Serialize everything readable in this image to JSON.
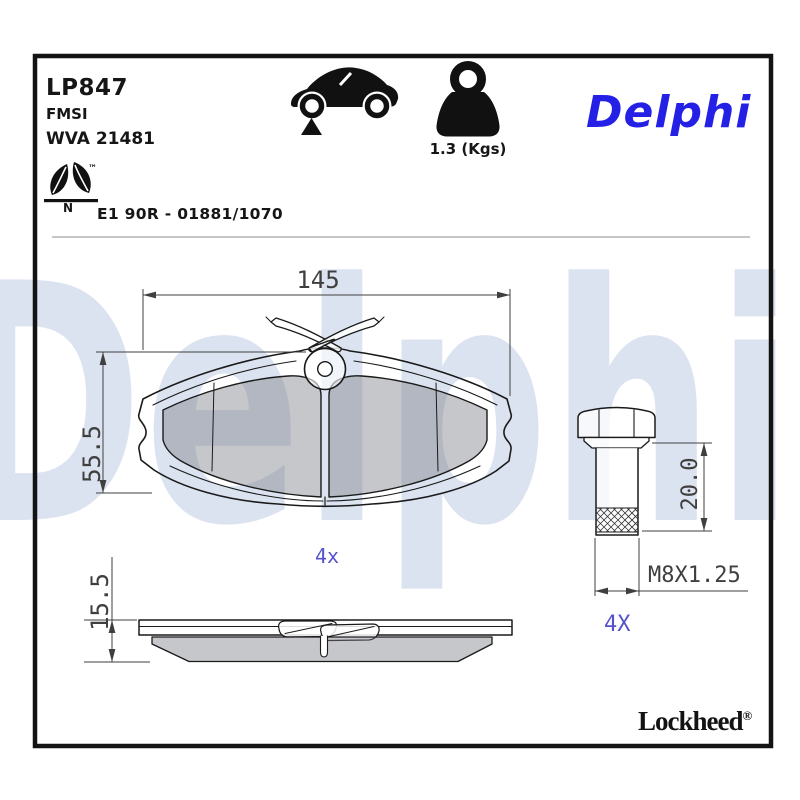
{
  "header": {
    "part_number": "LP847",
    "standard_label": "FMSI",
    "wva_code": "WVA 21481",
    "weight_value": "1.3 (Kgs)",
    "brand_logo": "Delphi",
    "eco_letter": "N",
    "eco_trademark": "™",
    "approval_code": "E1 90R - 01881/1070"
  },
  "drawing": {
    "width_dim": "145",
    "height_dim": "55.5",
    "thickness_dim": "15.5",
    "pad_qty": "4x",
    "bolt_length_dim": "20.0",
    "bolt_thread": "M8X1.25",
    "bolt_qty": "4X"
  },
  "footer": {
    "sub_brand": "Lockheed",
    "registered_mark": "®"
  },
  "watermark": "Delphi",
  "colors": {
    "brand_blue": "#2420e6",
    "annotation_blue": "#5551cc",
    "watermark_blue": "#dce3f0",
    "friction_gray": "#c8c8c8",
    "line_black": "#1a1a1a"
  }
}
